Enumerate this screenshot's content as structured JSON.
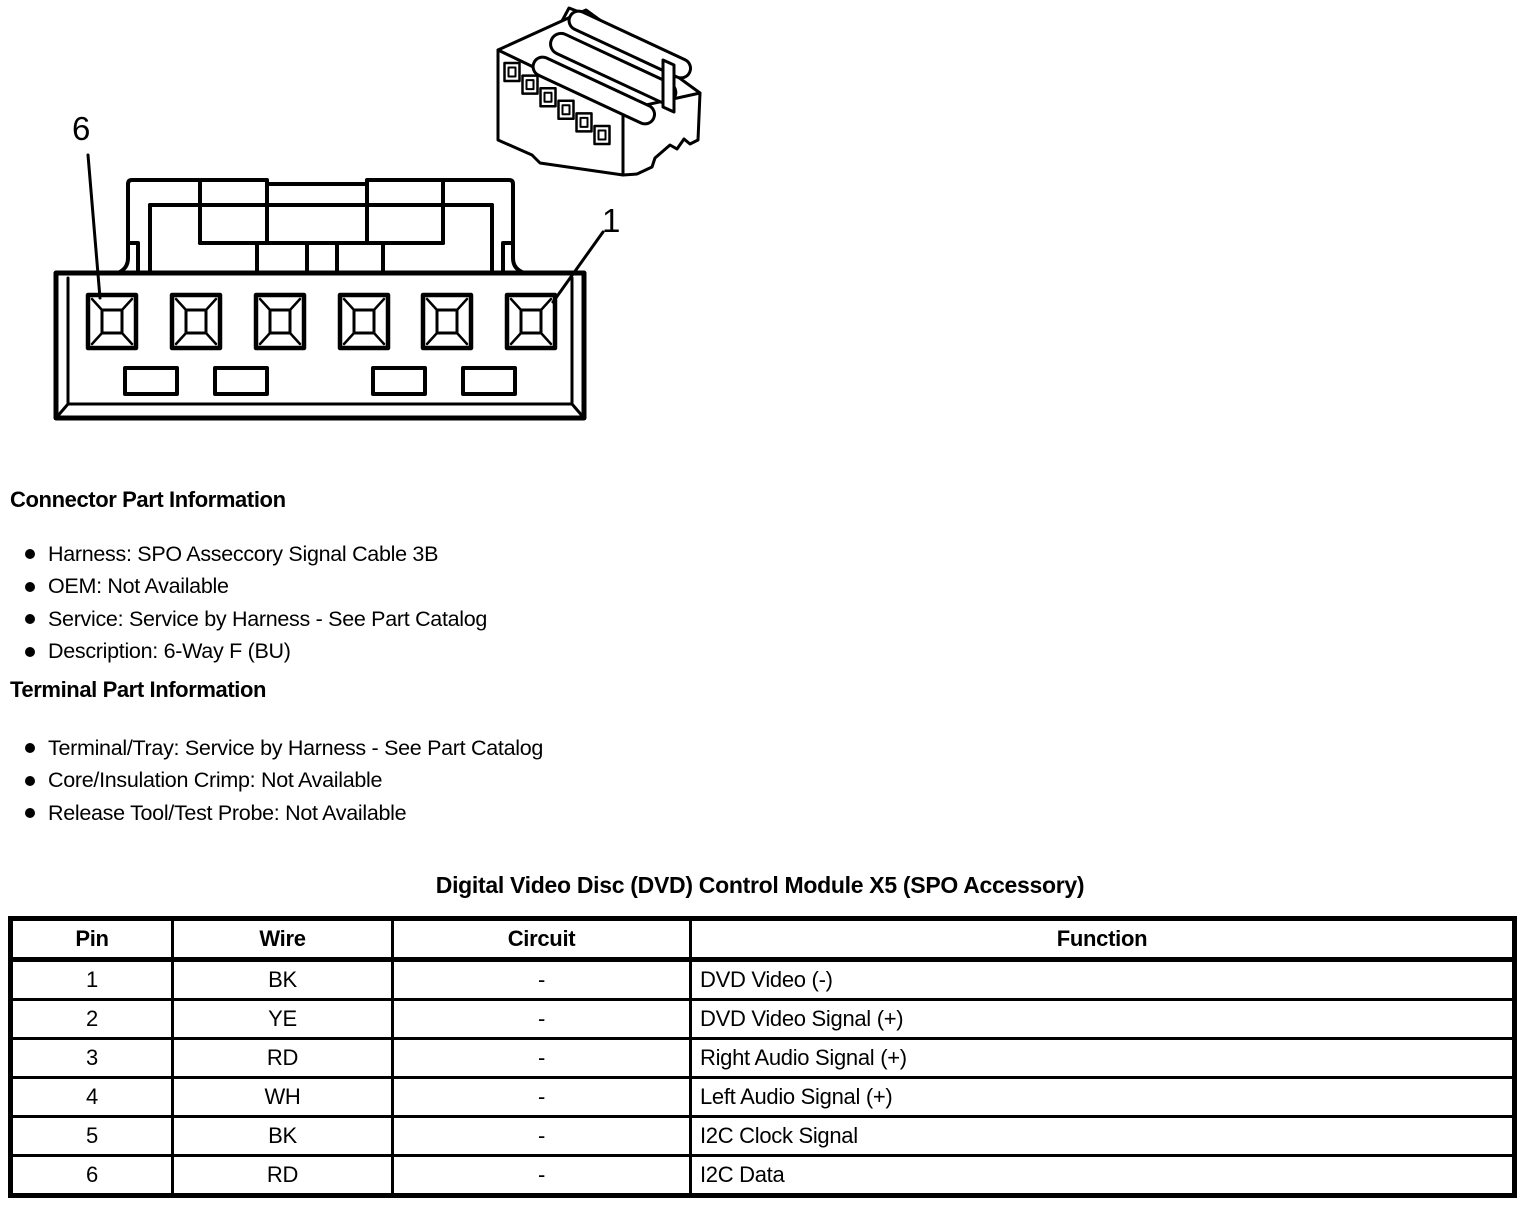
{
  "diagram": {
    "pin_label_left": "6",
    "pin_label_right": "1"
  },
  "connector_info": {
    "heading": "Connector Part Information",
    "items": [
      "Harness: SPO Asseccory Signal Cable 3B",
      "OEM: Not Available",
      "Service: Service by Harness - See Part Catalog",
      "Description: 6-Way F (BU)"
    ]
  },
  "terminal_info": {
    "heading": "Terminal Part Information",
    "items": [
      "Terminal/Tray: Service by Harness - See Part Catalog",
      "Core/Insulation Crimp: Not Available",
      "Release Tool/Test Probe: Not Available"
    ]
  },
  "pin_table": {
    "title": "Digital Video Disc (DVD) Control Module X5 (SPO Accessory)",
    "headers": [
      "Pin",
      "Wire",
      "Circuit",
      "Function"
    ],
    "rows": [
      [
        "1",
        "BK",
        "-",
        "DVD Video (-)"
      ],
      [
        "2",
        "YE",
        "-",
        "DVD Video Signal (+)"
      ],
      [
        "3",
        "RD",
        "-",
        "Right Audio Signal (+)"
      ],
      [
        "4",
        "WH",
        "-",
        "Left Audio Signal (+)"
      ],
      [
        "5",
        "BK",
        "-",
        "I2C Clock Signal"
      ],
      [
        "6",
        "RD",
        "-",
        "I2C Data"
      ]
    ]
  },
  "colors": {
    "ink": "#000000",
    "background": "#ffffff"
  }
}
